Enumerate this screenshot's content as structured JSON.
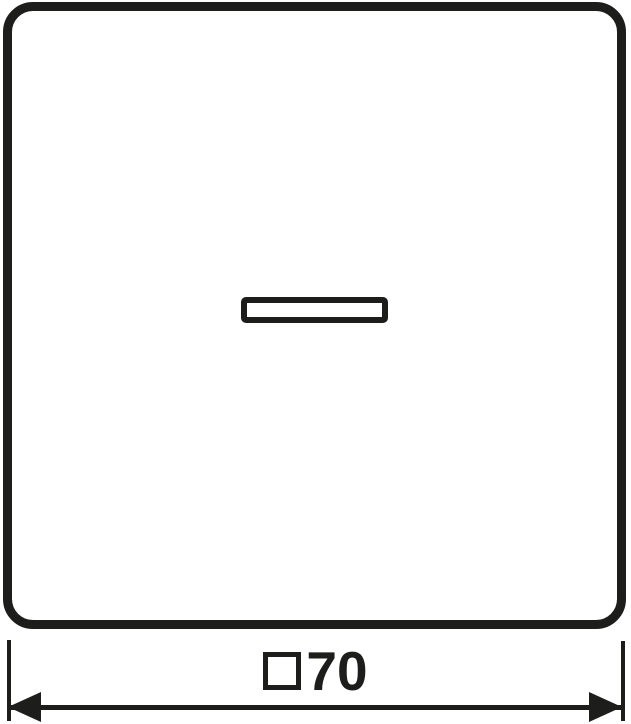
{
  "drawing": {
    "ink_color": "#1d1d1b",
    "background_color": "#ffffff",
    "dimension": {
      "symbol": "square",
      "value": "70",
      "label": "□70"
    }
  }
}
